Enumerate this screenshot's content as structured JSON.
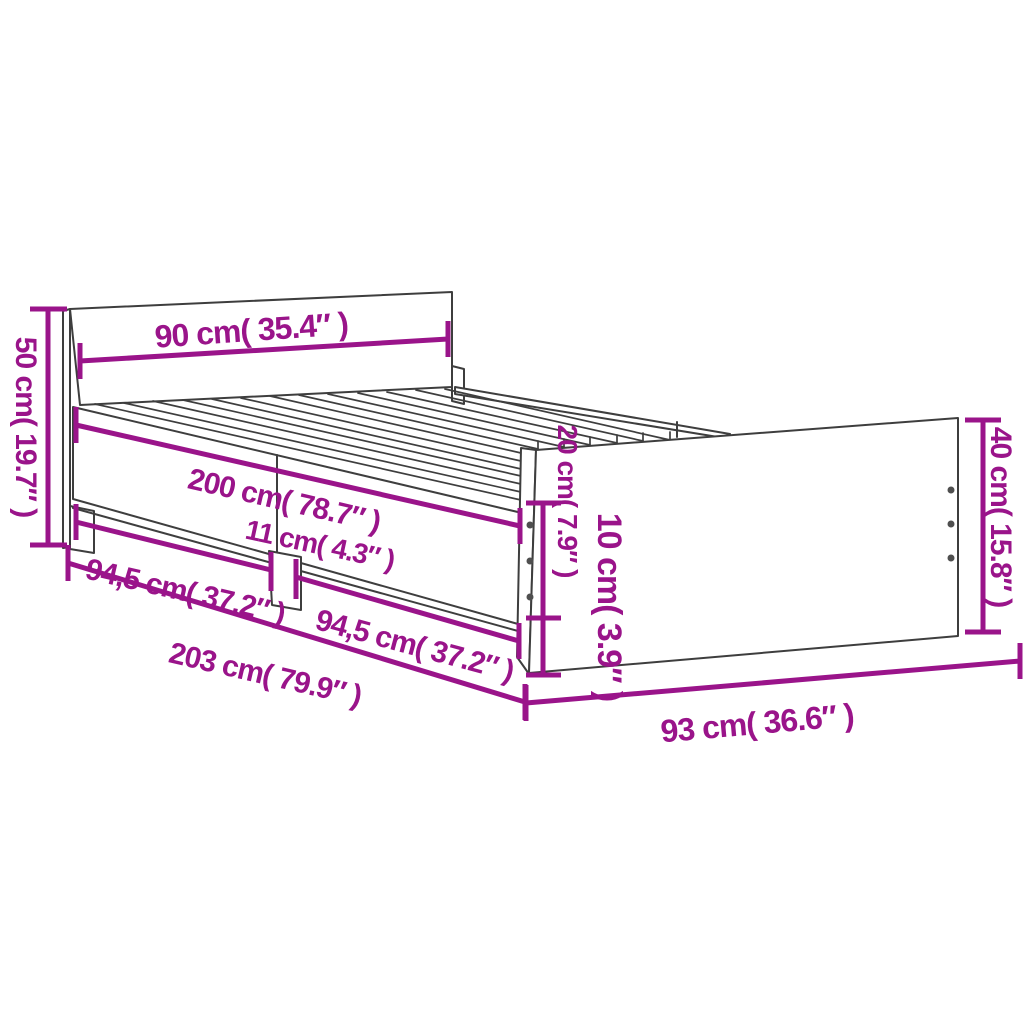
{
  "diagram": {
    "kind": "bed-frame-dimension-diagram",
    "colors": {
      "accent": "#9A148A",
      "outline": "#3E3E3E",
      "background": "#FFFFFF",
      "screw": "#4F4F4F"
    },
    "dimensions": {
      "headboard_width": "90 cm( 35.4″ )",
      "headboard_height": "50 cm( 19.7″ )",
      "mattress_length": "200 cm( 78.7″ )",
      "center_leg_width": "11 cm( 4.3″ )",
      "side_section_front": "94,5 cm( 37.2″ )",
      "side_section_rear": "94,5 cm( 37.2″ )",
      "total_length": "203 cm( 79.9″ )",
      "footboard_width": "93 cm( 36.6″ )",
      "footboard_height": "40 cm( 15.8″ )",
      "side_rail_height": "20 cm( 7.9″ )",
      "rail_bottom_height": "10 cm( 3.9″ )"
    }
  }
}
